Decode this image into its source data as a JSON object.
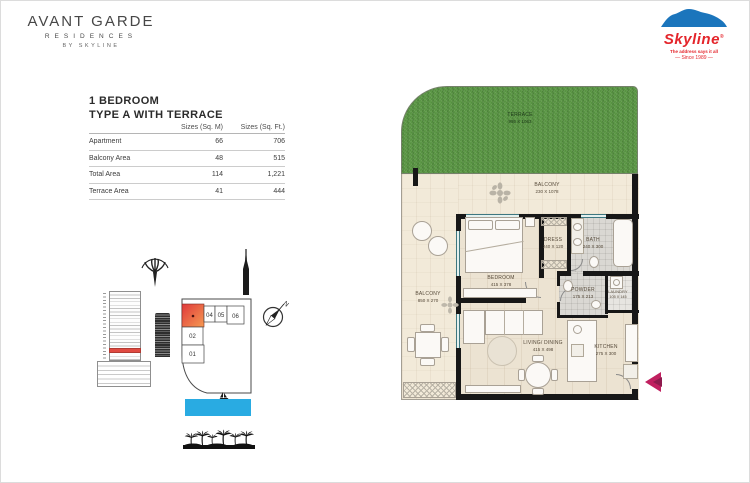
{
  "brand": {
    "line1": "AVANT GARDE",
    "line2": "RESIDENCES",
    "line3": "BY SKYLINE"
  },
  "skyline": {
    "name": "Skyline",
    "reg": "®",
    "tagline": "The address says it all",
    "since": "—  Since 1989  —"
  },
  "title": {
    "line1": "1 BEDROOM",
    "line2": "TYPE A WITH TERRACE"
  },
  "table": {
    "col_m": "Sizes (Sq. M)",
    "col_ft": "Sizes (Sq. Ft.)",
    "rows": [
      {
        "label": "Apartment",
        "sqm": "66",
        "sqft": "706"
      },
      {
        "label": "Balcony Area",
        "sqm": "48",
        "sqft": "515"
      },
      {
        "label": "Total Area",
        "sqm": "114",
        "sqft": "1,221"
      },
      {
        "label": "Terrace Area",
        "sqm": "41",
        "sqft": "444"
      }
    ]
  },
  "floorplan": {
    "terrace": {
      "name": "TERRACE",
      "dims": "995 X 1063"
    },
    "balcony_top": {
      "name": "BALCONY",
      "dims": "230 X 1078"
    },
    "balcony_left": {
      "name": "BALCONY",
      "dims": "850 X 270"
    },
    "bedroom": {
      "name": "BEDROOM",
      "dims": "415 X 378"
    },
    "dress": {
      "name": "DRESS",
      "dims": "240 X 120"
    },
    "bath": {
      "name": "BATH",
      "dims": "240 X 300"
    },
    "powder": {
      "name": "POWDER",
      "dims": "175 X 213"
    },
    "laundry": {
      "name": "LAUNDRY",
      "dims": "105 X 145"
    },
    "living": {
      "name": "LIVING/ DINING",
      "dims": "415 X 498"
    },
    "kitchen": {
      "name": "KITCHEN",
      "dims": "275 X 300"
    }
  },
  "keyplan": {
    "u04": "04",
    "u05": "05",
    "u06": "06",
    "u02": "02",
    "u01": "01"
  },
  "compass": {
    "n": "N"
  },
  "colors": {
    "terrace_green": "#5f9d48",
    "wall_black": "#171717",
    "sea_blue": "#29abe2",
    "skyline_red": "#e4252b",
    "skyline_blue": "#1b75bc",
    "keyplan_highlight_from": "#e0393b",
    "keyplan_highlight_to": "#f59a52",
    "entry_arrow": "#c02060"
  }
}
